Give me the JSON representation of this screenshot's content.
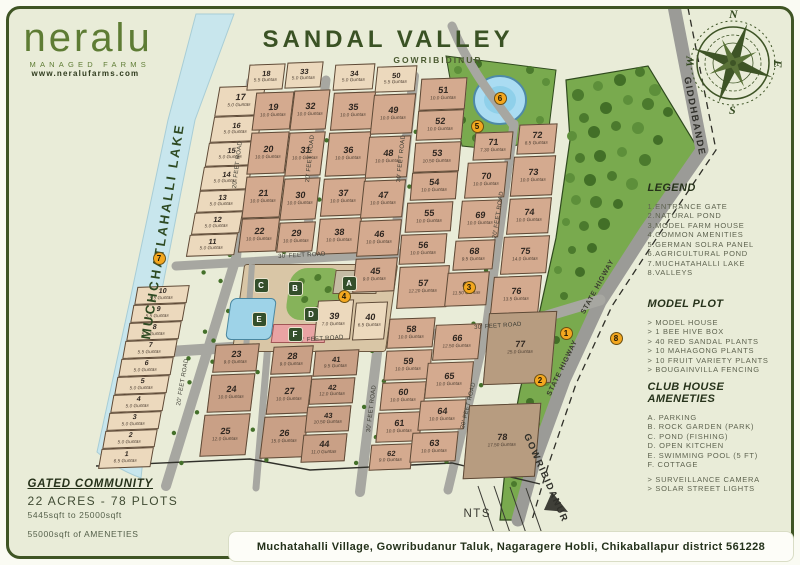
{
  "logo": {
    "name": "neralu",
    "tagline": "MANAGED FARMS",
    "website": "www.neralufarms.com"
  },
  "title": {
    "main": "SANDAL VALLEY",
    "sub": "GOWRIBIDINUR"
  },
  "compass": {
    "n": "N",
    "e": "E",
    "s": "S",
    "w": "W"
  },
  "legend": {
    "heading": "LEGEND",
    "items": [
      "1.ENTRANCE GATE",
      "2.NATURAL POND",
      "3.MODEL FARM HOUSE",
      "4.COMMON AMENITIES",
      "5.GERMAN SOLRA PANEL",
      "6.AGRICULTURAL POND",
      "7.MUCHATAHALLI LAKE",
      "8.VALLEYS"
    ]
  },
  "model_plot": {
    "heading": "MODEL PLOT",
    "items": [
      "> MODEL HOUSE",
      "> 1 BEE HIVE BOX",
      "> 40 RED SANDAL PLANTS",
      "> 10 MAHAGONG PLANTS",
      "> 10 FRUIT VARIETY PLANTS",
      "> BOUGAINVILLA FENCING"
    ]
  },
  "club_house": {
    "heading": "CLUB HOUSE AMENETIES",
    "items": [
      "A. PARKING",
      "B. ROCK GARDEN (PARK)",
      "C. POND (FISHING)",
      "D. OPEN KITCHEN",
      "E. SWIMMING POOL (5 FT)",
      "F. COTTAGE",
      "> SURVEILLANCE CAMERA",
      "> SOLAR STREET LIGHTS"
    ]
  },
  "summary": {
    "heading": "GATED COMMUNITY",
    "line1": "22 ACRES - 78 PLOTS",
    "line2": "5445sqft to 25000sqft",
    "line3": "55000sqft of AMENETIES"
  },
  "address": "Muchatahalli Village, Gowribudanur Taluk, Nagaragere Hobli, Chikaballapur district 561228",
  "nts_label": "NTS",
  "map": {
    "lake_label": "MUCHCHATLAHALLI LAKE",
    "road_labels": [
      {
        "text": "20' FEET ROAD",
        "x": 232,
        "y": 188,
        "rot": -83,
        "cls": "rl"
      },
      {
        "text": "20' FEET ROAD",
        "x": 176,
        "y": 405,
        "rot": -80,
        "cls": "rl"
      },
      {
        "text": "20' FEET ROAD",
        "x": 305,
        "y": 182,
        "rot": -84,
        "cls": "rl"
      },
      {
        "text": "30' FEET ROAD",
        "x": 396,
        "y": 182,
        "rot": -84,
        "cls": "rl"
      },
      {
        "text": "30' FEET ROAD",
        "x": 366,
        "y": 432,
        "rot": -83,
        "cls": "rl"
      },
      {
        "text": "20' FEET ROAD",
        "x": 492,
        "y": 238,
        "rot": -81,
        "cls": "rl"
      },
      {
        "text": "20' FEET ROAD",
        "x": 460,
        "y": 428,
        "rot": -76,
        "cls": "rl"
      },
      {
        "text": "30' FEET ROAD",
        "x": 278,
        "y": 254,
        "rot": -3,
        "cls": "rl"
      },
      {
        "text": "30' FEET ROAD",
        "x": 296,
        "y": 338,
        "rot": -4,
        "cls": "rl"
      },
      {
        "text": "30' FEET ROAD",
        "x": 474,
        "y": 325,
        "rot": -4,
        "cls": "rl"
      },
      {
        "text": "STATE HIGWAY",
        "x": 580,
        "y": 312,
        "rot": -61,
        "cls": "hw"
      },
      {
        "text": "STATE HIGWAY",
        "x": 546,
        "y": 394,
        "rot": -64,
        "cls": "hw"
      },
      {
        "text": "GIDDHBANDE",
        "x": 692,
        "y": 76,
        "rot": 79,
        "cls": "rb"
      },
      {
        "text": "GOWRIBIDANUR",
        "x": 531,
        "y": 432,
        "rot": 66,
        "cls": "rb"
      }
    ],
    "markers": [
      {
        "n": "1",
        "x": 560,
        "y": 327
      },
      {
        "n": "2",
        "x": 534,
        "y": 374
      },
      {
        "n": "3",
        "x": 463,
        "y": 281
      },
      {
        "n": "4",
        "x": 338,
        "y": 290
      },
      {
        "n": "5",
        "x": 471,
        "y": 120
      },
      {
        "n": "6",
        "x": 494,
        "y": 92
      },
      {
        "n": "7",
        "x": 153,
        "y": 252
      },
      {
        "n": "8",
        "x": 610,
        "y": 332
      }
    ],
    "amenity_chips": [
      {
        "letter": "A",
        "x": 342,
        "y": 276
      },
      {
        "letter": "B",
        "x": 288,
        "y": 281
      },
      {
        "letter": "C",
        "x": 254,
        "y": 278
      },
      {
        "letter": "D",
        "x": 304,
        "y": 307
      },
      {
        "letter": "E",
        "x": 252,
        "y": 312
      },
      {
        "letter": "F",
        "x": 288,
        "y": 327
      }
    ],
    "plots_format": [
      "number",
      "guntas",
      "x",
      "y",
      "w",
      "h",
      "shade",
      "skew_deg"
    ],
    "plots": [
      [
        1,
        "6.5 Guntas",
        100,
        448,
        52,
        20,
        "l",
        -12
      ],
      [
        2,
        "5.0 Guntas",
        104,
        430,
        52,
        18,
        "l",
        -12
      ],
      [
        3,
        "5.0 Guntas",
        108,
        412,
        52,
        18,
        "l",
        -12
      ],
      [
        4,
        "5.0 Guntas",
        112,
        394,
        52,
        18,
        "l",
        -12
      ],
      [
        5,
        "5.0 Guntas",
        116,
        376,
        52,
        18,
        "l",
        -12
      ],
      [
        6,
        "5.0 Guntas",
        120,
        358,
        52,
        18,
        "l",
        -12
      ],
      [
        7,
        "5.5 Guntas",
        124,
        340,
        52,
        18,
        "l",
        -12
      ],
      [
        8,
        "5.5 Guntas",
        128,
        322,
        52,
        18,
        "l",
        -12
      ],
      [
        9,
        "5.5 Guntas",
        132,
        304,
        52,
        18,
        "l",
        -12
      ],
      [
        10,
        "5.5 Guntas",
        136,
        286,
        52,
        18,
        "l",
        -12
      ],
      [
        11,
        "5.0 Guntas",
        188,
        234,
        48,
        22,
        "l",
        -12
      ],
      [
        12,
        "5.0 Guntas",
        193,
        212,
        48,
        22,
        "l",
        -12
      ],
      [
        13,
        "5.0 Guntas",
        198,
        190,
        48,
        22,
        "l",
        -12
      ],
      [
        14,
        "5.0 Guntas",
        202,
        166,
        48,
        24,
        "l",
        -12
      ],
      [
        15,
        "5.0 Guntas",
        207,
        142,
        48,
        24,
        "l",
        -12
      ],
      [
        16,
        "5.0 Guntas",
        212,
        116,
        48,
        26,
        "l",
        -12
      ],
      [
        17,
        "5.0 Guntas",
        217,
        86,
        46,
        30,
        "l",
        -12
      ],
      [
        18,
        "5.5 Guntas",
        248,
        64,
        36,
        26,
        "l",
        -9
      ],
      [
        19,
        "10.0 Guntas",
        254,
        92,
        38,
        38,
        "m",
        -9
      ],
      [
        20,
        "10.0 Guntas",
        249,
        132,
        38,
        42,
        "m",
        -9
      ],
      [
        21,
        "10.0 Guntas",
        244,
        176,
        38,
        42,
        "m",
        -9
      ],
      [
        22,
        "10.0 Guntas",
        240,
        218,
        38,
        34,
        "m",
        -9
      ],
      [
        23,
        "9.0 Guntas",
        214,
        344,
        44,
        28,
        "m2",
        -9
      ],
      [
        24,
        "10.0 Guntas",
        209,
        374,
        44,
        38,
        "m2",
        -9
      ],
      [
        25,
        "12.0 Guntas",
        202,
        414,
        46,
        42,
        "m2",
        -9
      ],
      [
        26,
        "15.0 Guntas",
        262,
        416,
        44,
        42,
        "m2",
        -9
      ],
      [
        27,
        "10.0 Guntas",
        268,
        376,
        42,
        38,
        "m2",
        -9
      ],
      [
        28,
        "9.0 Guntas",
        272,
        346,
        40,
        28,
        "m2",
        -9
      ],
      [
        29,
        "10.0 Guntas",
        278,
        222,
        36,
        30,
        "m",
        -9
      ],
      [
        30,
        "10.0 Guntas",
        282,
        178,
        36,
        42,
        "m",
        -9
      ],
      [
        31,
        "10.0 Guntas",
        287,
        132,
        36,
        44,
        "m",
        -9
      ],
      [
        32,
        "10.0 Guntas",
        292,
        90,
        36,
        40,
        "m",
        -9
      ],
      [
        33,
        "5.0 Guntas",
        286,
        62,
        36,
        26,
        "l",
        -9
      ],
      [
        34,
        "5.0 Guntas",
        334,
        64,
        40,
        26,
        "l",
        -8
      ],
      [
        35,
        "10.0 Guntas",
        332,
        92,
        42,
        38,
        "m",
        -8
      ],
      [
        36,
        "10.0 Guntas",
        327,
        132,
        42,
        44,
        "m",
        -8
      ],
      [
        37,
        "10.0 Guntas",
        322,
        178,
        42,
        38,
        "m",
        -8
      ],
      [
        38,
        "10.0 Guntas",
        318,
        218,
        42,
        36,
        "m",
        -8
      ],
      [
        39,
        "7.0 Guntas",
        316,
        300,
        36,
        40,
        "l",
        -8
      ],
      [
        40,
        "6.5 Guntas",
        354,
        302,
        32,
        38,
        "l",
        -8
      ],
      [
        41,
        "9.5 Guntas",
        314,
        350,
        44,
        26,
        "m2",
        -8
      ],
      [
        42,
        "12.0 Guntas",
        310,
        378,
        44,
        26,
        "m2",
        -8
      ],
      [
        43,
        "10.50 Guntas",
        306,
        406,
        44,
        26,
        "m2",
        -8
      ],
      [
        44,
        "11.0 Guntas",
        302,
        434,
        44,
        28,
        "m2",
        -8
      ],
      [
        45,
        "9.0 Guntas",
        354,
        258,
        42,
        34,
        "m",
        -8
      ],
      [
        46,
        "10.0 Guntas",
        358,
        220,
        42,
        36,
        "m",
        -8
      ],
      [
        47,
        "10.0 Guntas",
        362,
        180,
        42,
        38,
        "m",
        -8
      ],
      [
        48,
        "10.0 Guntas",
        367,
        136,
        42,
        42,
        "m",
        -8
      ],
      [
        49,
        "10.0 Guntas",
        372,
        94,
        42,
        40,
        "m",
        -8
      ],
      [
        50,
        "5.5 Guntas",
        376,
        66,
        40,
        26,
        "l",
        -8
      ],
      [
        51,
        "10.0 Guntas",
        420,
        78,
        46,
        32,
        "m",
        -7
      ],
      [
        52,
        "10.0 Guntas",
        417,
        110,
        46,
        30,
        "m",
        -7
      ],
      [
        53,
        "10.50 Guntas",
        414,
        142,
        46,
        30,
        "m",
        -7
      ],
      [
        54,
        "10.0 Guntas",
        411,
        172,
        46,
        28,
        "m",
        -7
      ],
      [
        55,
        "10.0 Guntas",
        406,
        202,
        46,
        30,
        "m",
        -7
      ],
      [
        56,
        "10.0 Guntas",
        400,
        234,
        46,
        30,
        "m",
        -7
      ],
      [
        57,
        "12.20 Guntas",
        398,
        266,
        50,
        42,
        "m",
        -7
      ],
      [
        58,
        "10.0 Guntas",
        388,
        318,
        46,
        30,
        "m",
        -8
      ],
      [
        59,
        "10.0 Guntas",
        385,
        350,
        46,
        30,
        "m",
        -8
      ],
      [
        60,
        "10.0 Guntas",
        381,
        382,
        44,
        28,
        "m",
        -8
      ],
      [
        61,
        "10.0 Guntas",
        377,
        412,
        44,
        30,
        "m",
        -8
      ],
      [
        62,
        "9.0 Guntas",
        370,
        444,
        42,
        26,
        "m",
        -8
      ],
      [
        63,
        "10.0 Guntas",
        411,
        432,
        46,
        30,
        "m",
        -8
      ],
      [
        64,
        "10.0 Guntas",
        419,
        400,
        46,
        30,
        "m",
        -8
      ],
      [
        65,
        "10.0 Guntas",
        426,
        362,
        46,
        36,
        "m",
        -8
      ],
      [
        66,
        "12.50 Guntas",
        434,
        324,
        46,
        36,
        "m",
        -8
      ],
      [
        67,
        "11.50 Guntas",
        446,
        272,
        42,
        34,
        "m",
        -8
      ],
      [
        68,
        "9.5 Guntas",
        454,
        240,
        40,
        30,
        "m",
        -8
      ],
      [
        69,
        "10.0 Guntas",
        460,
        200,
        40,
        38,
        "m",
        -8
      ],
      [
        70,
        "10.0 Guntas",
        466,
        162,
        40,
        36,
        "m",
        -8
      ],
      [
        71,
        "7.30 Guntas",
        474,
        132,
        38,
        28,
        "m",
        -8
      ],
      [
        72,
        "8.5 Guntas",
        518,
        124,
        38,
        30,
        "m",
        -8
      ],
      [
        73,
        "10.0 Guntas",
        512,
        156,
        42,
        40,
        "m",
        -8
      ],
      [
        74,
        "10.0 Guntas",
        508,
        198,
        42,
        36,
        "m",
        -8
      ],
      [
        75,
        "14.0 Guntas",
        502,
        236,
        46,
        38,
        "m",
        -8
      ],
      [
        76,
        "13.5 Guntas",
        492,
        276,
        48,
        38,
        "m",
        -8
      ],
      [
        77,
        "25.0 Guntas",
        486,
        312,
        68,
        72,
        "d",
        -7
      ],
      [
        78,
        "17.50 Guntas",
        466,
        404,
        72,
        74,
        "d",
        -7
      ]
    ]
  },
  "colors": {
    "background": "#e9ecd8",
    "frame": "#3f5524",
    "heading": "#26321a",
    "plot_main": "#d4aa8f",
    "plot_light": "#ecd9bd",
    "plot_dark": "#b79c80",
    "road": "#a7a7a1",
    "lake": "#c8e6ed",
    "forest": "#79aa4e",
    "marker": "#f3a71f",
    "chip": "#344f2b",
    "pond": "#aadcf2"
  }
}
